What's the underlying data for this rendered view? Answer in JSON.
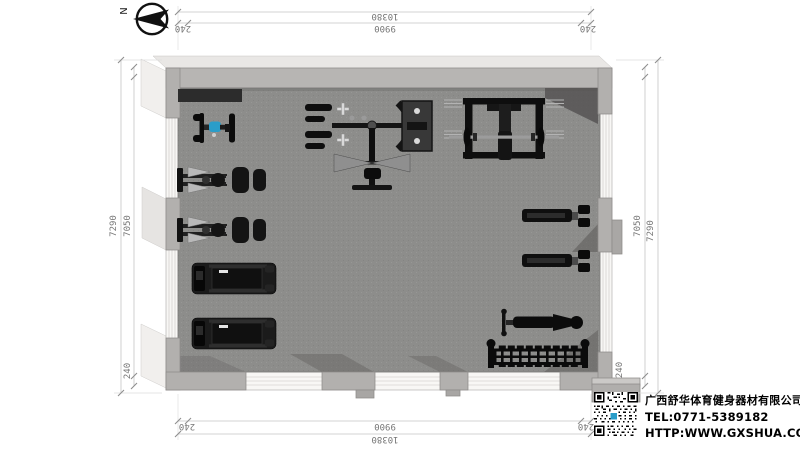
{
  "compass": {
    "label": "N"
  },
  "dims": {
    "top": {
      "outer": "10380",
      "inner": "9900",
      "corner_left": "240",
      "corner_right": "240"
    },
    "bottom": {
      "outer": "10380",
      "inner": "9900",
      "corner_left": "240",
      "corner_right": "240"
    },
    "left": {
      "outer": "7290",
      "inner": "7050",
      "corner_bottom": "240"
    },
    "right": {
      "outer": "7290",
      "inner": "7050",
      "corner_bottom": "240"
    }
  },
  "company": {
    "name": "广西舒华体育健身器材有限公司",
    "tel": "TEL:0771-5389182",
    "website": "HTTP:WWW.GXSHUA.COM"
  },
  "plan": {
    "type": "gym-equipment-floor-plan",
    "equipment": [
      {
        "name": "floor-mat"
      },
      {
        "name": "exercise-bike"
      },
      {
        "name": "strength-machine"
      },
      {
        "name": "strength-machine"
      },
      {
        "name": "treadmill"
      },
      {
        "name": "treadmill"
      },
      {
        "name": "multi-station-trainer"
      },
      {
        "name": "squat-rack-with-barbell"
      },
      {
        "name": "bench-press-machine"
      },
      {
        "name": "bench-press-machine"
      },
      {
        "name": "adjustable-bench"
      },
      {
        "name": "dumbbell-rack"
      }
    ],
    "colors": {
      "floor": "#8d8d8b",
      "walls": "#b2b0ae",
      "accent_blue": "#2a9dc9"
    }
  }
}
